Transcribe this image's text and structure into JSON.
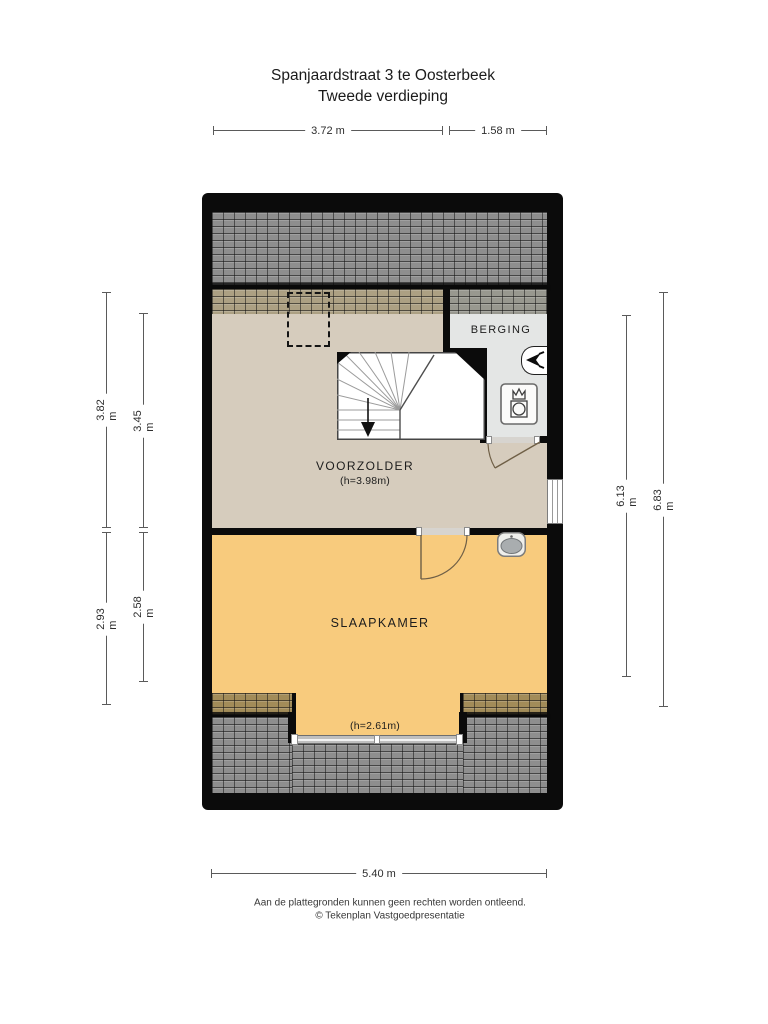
{
  "title": {
    "line1": "Spanjaardstraat 3 te Oosterbeek",
    "line2": "Tweede verdieping"
  },
  "rooms": {
    "voorzolder": {
      "name": "VOORZOLDER",
      "height": "(h=3.98m)"
    },
    "berging": {
      "name": "BERGING"
    },
    "slaapkamer": {
      "name": "SLAAPKAMER",
      "dormer_height": "(h=2.61m)"
    }
  },
  "dimensions": {
    "top": [
      {
        "label": "3.72 m"
      },
      {
        "label": "1.58 m"
      }
    ],
    "bottom": [
      {
        "label": "5.40 m"
      }
    ],
    "left_outer": [
      {
        "label": "3.82 m"
      },
      {
        "label": "2.93 m"
      }
    ],
    "left_inner": [
      {
        "label": "3.45 m"
      },
      {
        "label": "2.58 m"
      }
    ],
    "right_inner": [
      {
        "label": "6.13 m"
      }
    ],
    "right_outer": [
      {
        "label": "6.83 m"
      }
    ]
  },
  "footer": {
    "line1": "Aan de plattegronden kunnen geen rechten worden ontleend.",
    "line2": "© Tekenplan Vastgoedpresentatie"
  },
  "icons": {
    "ventilation": "mechanical-ventilation-icon",
    "boiler": "boiler-icon",
    "sink": "sink-icon",
    "stairs": "stairs-down-arrow-icon"
  },
  "colors": {
    "wall": "#0b0b0b",
    "roof_tile": "#8e8e8e",
    "roof_over_attic": "#aca083",
    "roof_over_storage": "#98988f",
    "roof_over_bedroom": "#a28c59",
    "floor_attic": "#d6ccbd",
    "floor_storage": "#e4e6e5",
    "floor_bedroom": "#f8cb7d",
    "dim_line": "#5a5a5a",
    "text": "#1e1e1e"
  }
}
